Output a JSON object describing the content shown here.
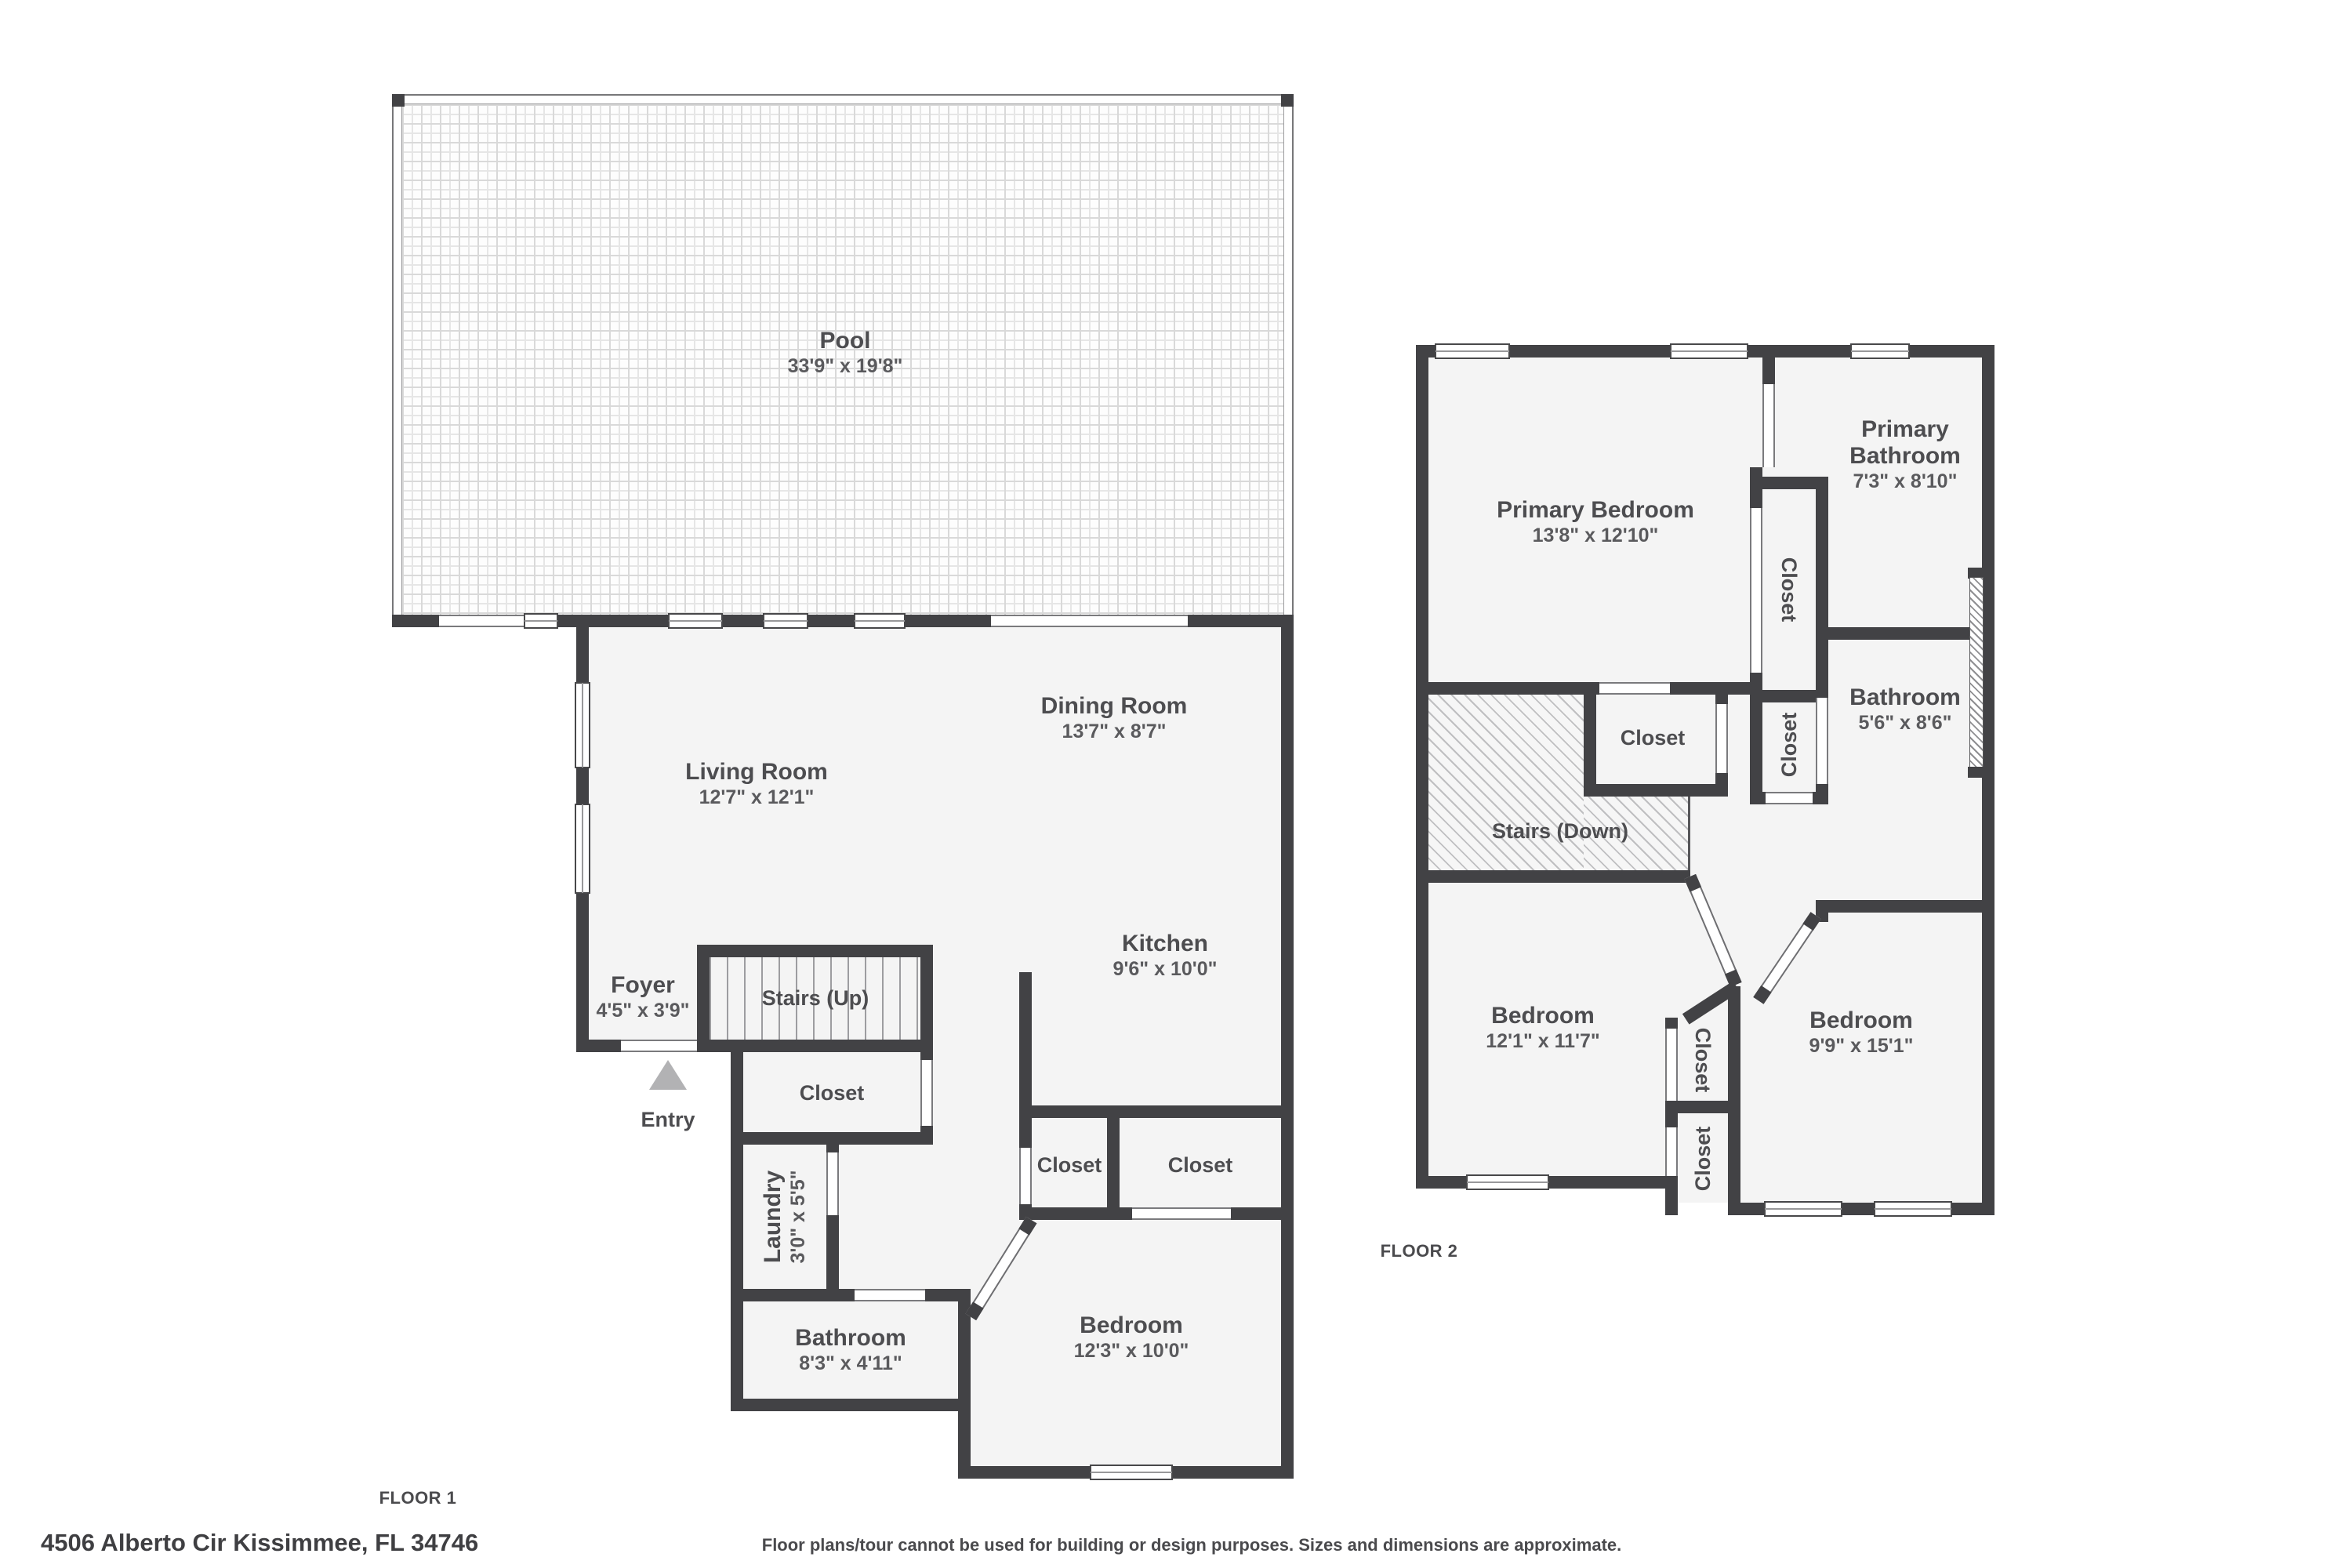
{
  "footer": {
    "address": "4506 Alberto Cir Kissimmee, FL 34746",
    "disclaimer": "Floor plans/tour cannot be used for building or design purposes. Sizes and dimensions are approximate."
  },
  "floor1": {
    "label": "FLOOR 1",
    "pool": {
      "name": "Pool",
      "dims": "33'9\" x 19'8\""
    },
    "living_room": {
      "name": "Living Room",
      "dims": "12'7\" x 12'1\""
    },
    "dining_room": {
      "name": "Dining Room",
      "dims": "13'7\" x 8'7\""
    },
    "kitchen": {
      "name": "Kitchen",
      "dims": "9'6\" x 10'0\""
    },
    "foyer": {
      "name": "Foyer",
      "dims": "4'5\" x 3'9\""
    },
    "stairs": {
      "name": "Stairs (Up)"
    },
    "entry": {
      "name": "Entry"
    },
    "closet_hall": {
      "name": "Closet"
    },
    "laundry": {
      "name": "Laundry",
      "dims": "3'0\" x 5'5\""
    },
    "bathroom": {
      "name": "Bathroom",
      "dims": "8'3\" x 4'11\""
    },
    "closet_a": {
      "name": "Closet"
    },
    "closet_b": {
      "name": "Closet"
    },
    "bedroom": {
      "name": "Bedroom",
      "dims": "12'3\" x 10'0\""
    }
  },
  "floor2": {
    "label": "FLOOR 2",
    "primary_bedroom": {
      "name": "Primary Bedroom",
      "dims": "13'8\" x 12'10\""
    },
    "primary_bathroom": {
      "name": "Primary Bathroom",
      "dims": "7'3\" x 8'10\""
    },
    "closet_primary": {
      "name": "Closet"
    },
    "closet_mid": {
      "name": "Closet"
    },
    "bathroom": {
      "name": "Bathroom",
      "dims": "5'6\" x 8'6\""
    },
    "closet_hall": {
      "name": "Closet"
    },
    "stairs": {
      "name": "Stairs (Down)"
    },
    "bedroom_left": {
      "name": "Bedroom",
      "dims": "12'1\" x 11'7\""
    },
    "bedroom_right": {
      "name": "Bedroom",
      "dims": "9'9\" x 15'1\""
    },
    "closet_upper": {
      "name": "Closet"
    },
    "closet_lower": {
      "name": "Closet"
    }
  }
}
